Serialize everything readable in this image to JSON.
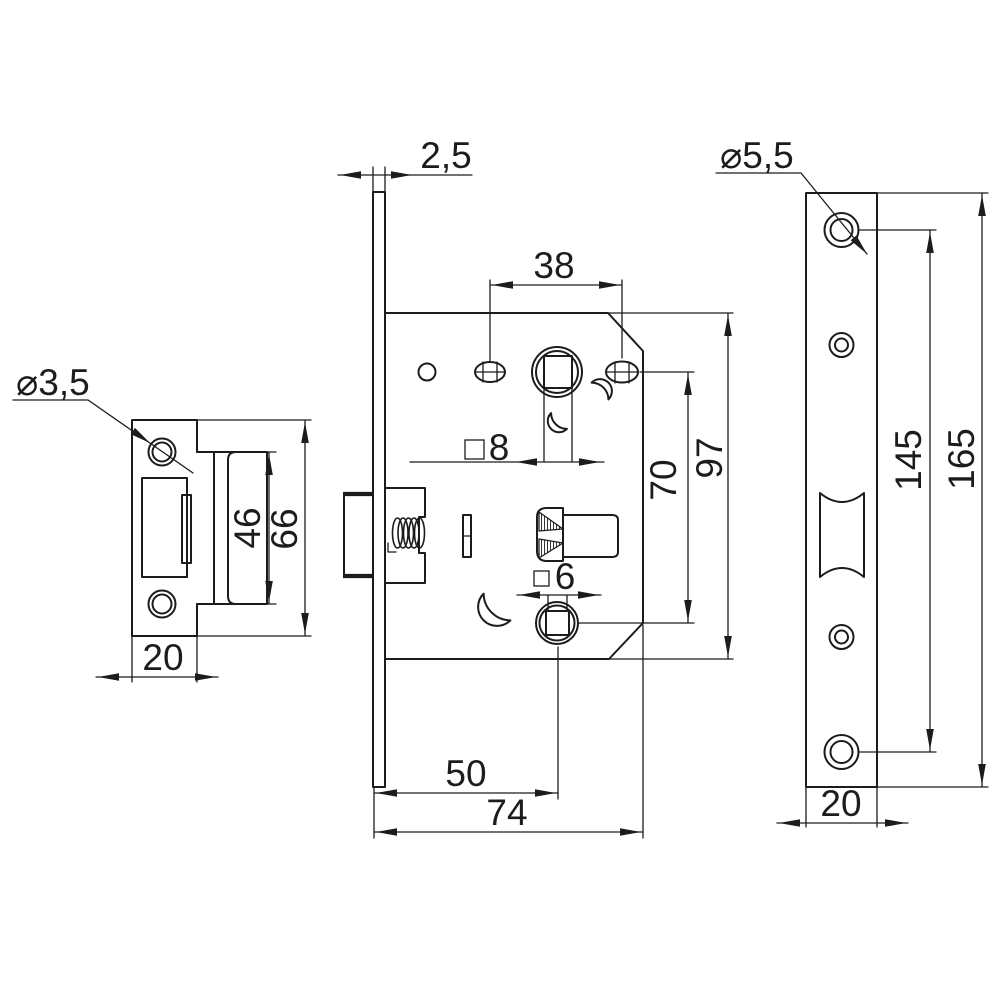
{
  "drawing": {
    "background": "#ffffff",
    "line_color": "#1c1c1c",
    "views": {
      "strike_plate": {
        "hole_diameter": "⌀3,5",
        "cutout_height": "46",
        "plate_height": "66",
        "plate_width": "20"
      },
      "lock_body": {
        "faceplate_thickness": "2,5",
        "handle_hole_spacing": "38",
        "spindle_square_size": "8",
        "hole_center_distance": "70",
        "body_height": "97",
        "wc_square_size": "6",
        "backset": "50",
        "body_depth": "74"
      },
      "faceplate": {
        "hole_diameter": "⌀5,5",
        "screw_hole_spacing": "145",
        "plate_length": "165",
        "plate_width": "20"
      }
    }
  }
}
